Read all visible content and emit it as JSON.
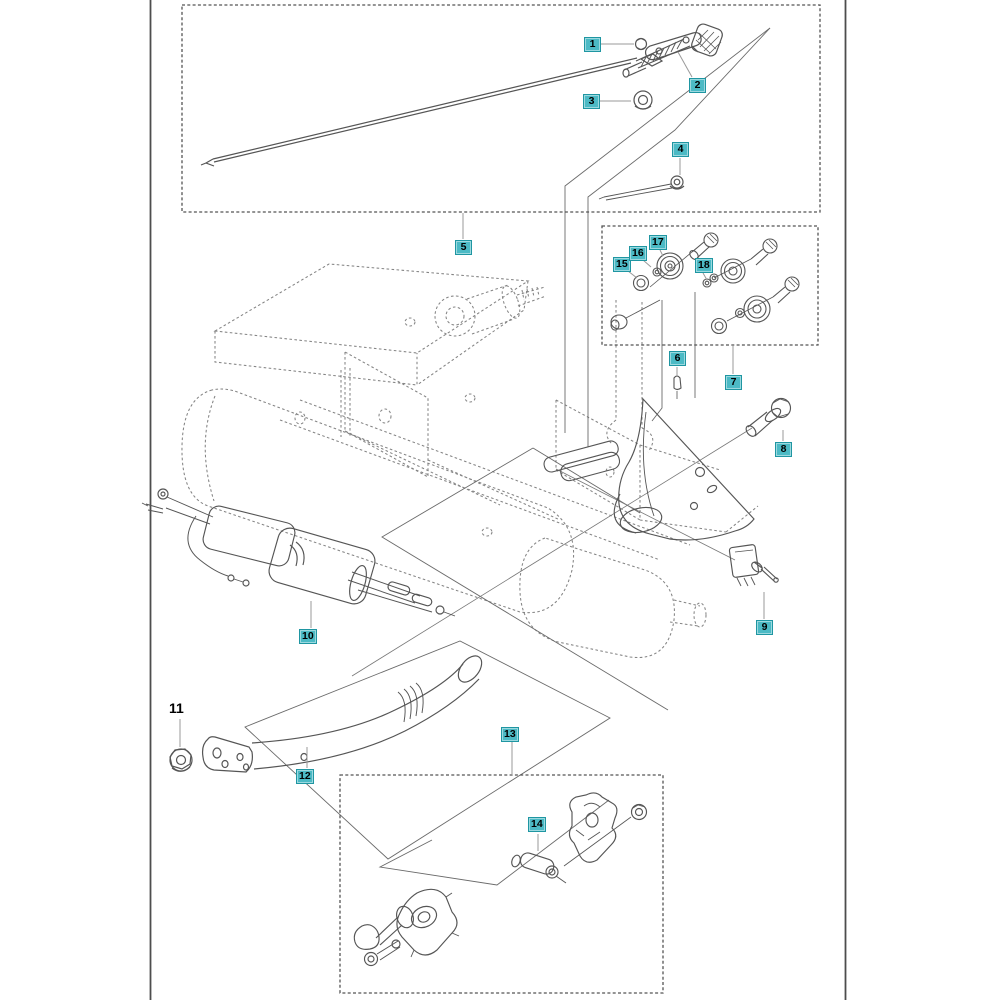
{
  "diagram": {
    "kind": "exploded-parts-diagram",
    "callouts": {
      "c1": "1",
      "c2": "2",
      "c3": "3",
      "c4": "4",
      "c5": "5",
      "c6": "6",
      "c7": "7",
      "c8": "8",
      "c9": "9",
      "c10": "10",
      "c11": "11",
      "c12": "12",
      "c13": "13",
      "c14": "14",
      "c15": "15",
      "c16": "16",
      "c17": "17",
      "c18": "18"
    },
    "colors": {
      "callout_highlight": "#4cbac5",
      "callout_border": "#1f96a2",
      "solid_line": "#555555",
      "dashed_line": "#848484",
      "leader_line": "#9a9a9a",
      "page_frame": "#4d4d4d"
    }
  }
}
